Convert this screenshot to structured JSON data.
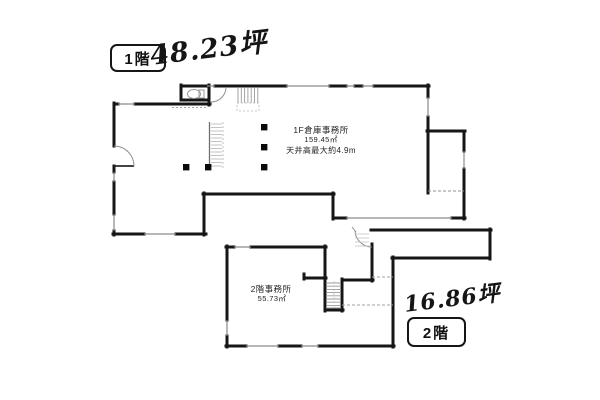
{
  "document": {
    "type": "floor-plan-scan"
  },
  "floor1": {
    "badge": "1階",
    "handwritten_area": "48.23坪",
    "room_label": "1F倉庫事務所",
    "room_area": "159.45㎡",
    "ceiling_note": "天井高最大約4.9m"
  },
  "floor2": {
    "badge": "2階",
    "handwritten_area": "16.86坪",
    "room_label": "2階事務所",
    "room_area": "55.73㎡"
  },
  "colors": {
    "ink": "#161616",
    "paper": "#ffffff",
    "window_line": "#8a8a8a",
    "hatch_line": "#9a9a9a"
  }
}
